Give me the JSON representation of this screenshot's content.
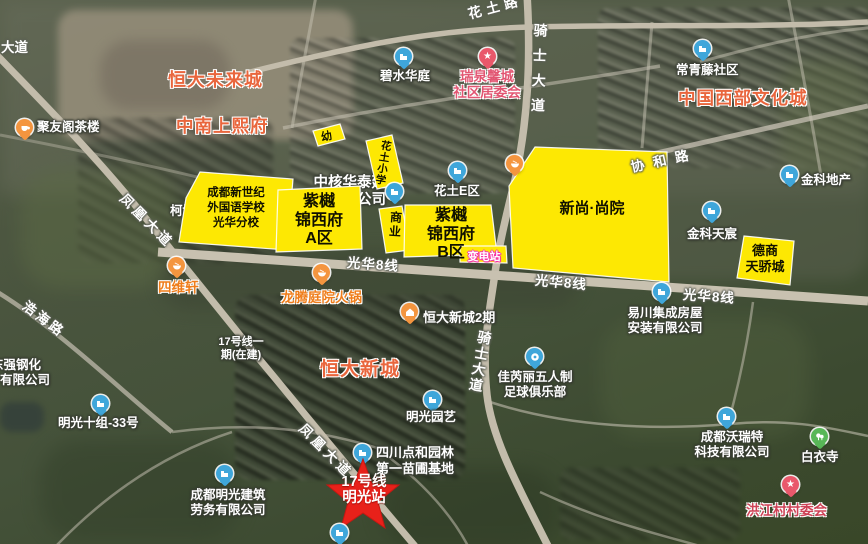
{
  "map_type": "satellite-annotated",
  "colors": {
    "parcel_fill": "#fde803",
    "parcel_stroke": "#ffffff",
    "area_label": "#e9663d",
    "committee_label": "#e25672",
    "village_label": "#ce4256",
    "restaurant_label": "#ef7d1a",
    "station_star": "#e8211a",
    "pin_blue": "#3fa6da",
    "pin_orange": "#f4953f",
    "pin_red": "#e9586b",
    "pin_green": "#58b757",
    "road": "#c3bcab"
  },
  "parcels": [
    {
      "name": "kindergarten",
      "text": "幼"
    },
    {
      "name": "huatu-primary-school",
      "text": "花土小学"
    },
    {
      "name": "new-century-school",
      "text": "成都新世纪\n外国语学校\n光华分校"
    },
    {
      "name": "ziyue-jinxifu-a",
      "text": "紫樾\n锦西府\nA区"
    },
    {
      "name": "commercial-strip",
      "text": "商业"
    },
    {
      "name": "ziyue-jinxifu-b",
      "text": "紫樾\n锦西府\nB区"
    },
    {
      "name": "substation",
      "text": "变电站"
    },
    {
      "name": "xinshang-shangyuan",
      "text": "新尚·尚院"
    },
    {
      "name": "deshang-tianjiaocheng",
      "text": "德商\n天骄城"
    }
  ],
  "area_labels": [
    {
      "text": "恒大未来城"
    },
    {
      "text": "中南上熙府"
    },
    {
      "text": "中国西部文化城"
    },
    {
      "text": "恒大新城"
    }
  ],
  "road_labels": [
    {
      "text": "大道"
    },
    {
      "text": "花土路"
    },
    {
      "text": "骑士大道"
    },
    {
      "text": "骑士大道"
    },
    {
      "text": "凤凰大道"
    },
    {
      "text": "凤凰大道"
    },
    {
      "text": "浩海路"
    },
    {
      "text": "协和路"
    },
    {
      "text": "光华8线"
    },
    {
      "text": "光华8线"
    },
    {
      "text": "光华8线"
    }
  ],
  "pois": [
    {
      "icon": "teacup",
      "label": "聚友阁茶楼"
    },
    {
      "icon": "building",
      "label": "碧水华庭"
    },
    {
      "icon": "building",
      "label": "常青藤社区"
    },
    {
      "icon": "star",
      "label": "瑞泉馨城\n社区居委会"
    },
    {
      "icon": "building",
      "label": "花土E区"
    },
    {
      "icon": "building",
      "label": "金科地产"
    },
    {
      "icon": "building",
      "label": "金科天宸"
    },
    {
      "icon": "building",
      "label": "中核华泰建设\n有限公司"
    },
    {
      "icon": "bowl",
      "label": ""
    },
    {
      "icon": "bowl",
      "label": "四维轩"
    },
    {
      "icon": "bowl",
      "label": "龙腾庭院火锅"
    },
    {
      "icon": "house",
      "label": "恒大新城2期"
    },
    {
      "icon": "building",
      "label": "易川集成房屋\n安装有限公司"
    },
    {
      "icon": "soccer",
      "label": "佳芮丽五人制\n足球俱乐部"
    },
    {
      "icon": "building",
      "label": "明光园艺"
    },
    {
      "icon": "building",
      "label": "明光十组-33号"
    },
    {
      "icon": "building",
      "label": "成都明光建筑\n劳务有限公司"
    },
    {
      "icon": "building",
      "label": "成都沃瑞特\n科技有限公司"
    },
    {
      "icon": "trees",
      "label": "白衣寺"
    },
    {
      "icon": "star",
      "label": "洪江村村委会"
    },
    {
      "icon": "building",
      "label": "四川点和园林\n第一苗圃基地"
    },
    {
      "icon": "building",
      "label": ""
    }
  ],
  "station": {
    "label": "17号线\n明光站"
  },
  "misc": {
    "metro_note": "17号线一\n期(在建)",
    "kebo": "柯博",
    "dongqiang_line1": "东强钢化",
    "dongqiang_line2": "有限公司"
  }
}
